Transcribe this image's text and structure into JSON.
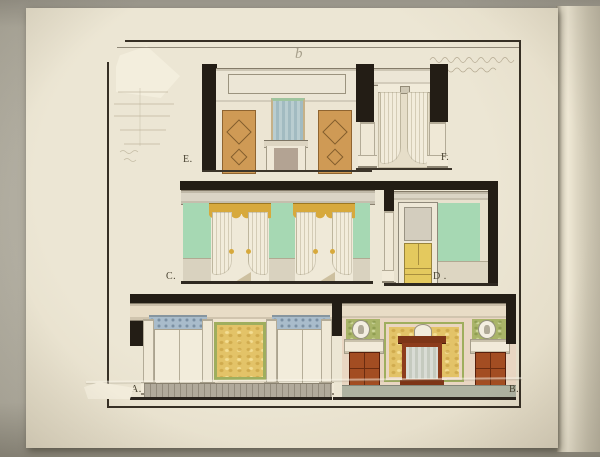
{
  "labels": {
    "A": "A.",
    "B": "B.",
    "C": "C.",
    "D": "D .",
    "E": "E.",
    "F": "F.",
    "top_center_mark": "b"
  },
  "colors": {
    "backdrop": "#b3afa2",
    "paper": "#e9e2cf",
    "ink_frame": "#362f24",
    "poche_black": "#231d15",
    "wall_green": "#a6d8b3",
    "valance_gold": "#d7a93c",
    "door_orange": "#cf9a55",
    "door_yellow": "#e4c95e",
    "door_red": "#a34d22",
    "panel_yellow_mottled": "#e3c368",
    "panel_green_mottled": "#a9b468",
    "frieze_blue": "#a9bccb",
    "mantel_red": "#8d3c1c",
    "mirror_blue": "#aac2c6"
  }
}
